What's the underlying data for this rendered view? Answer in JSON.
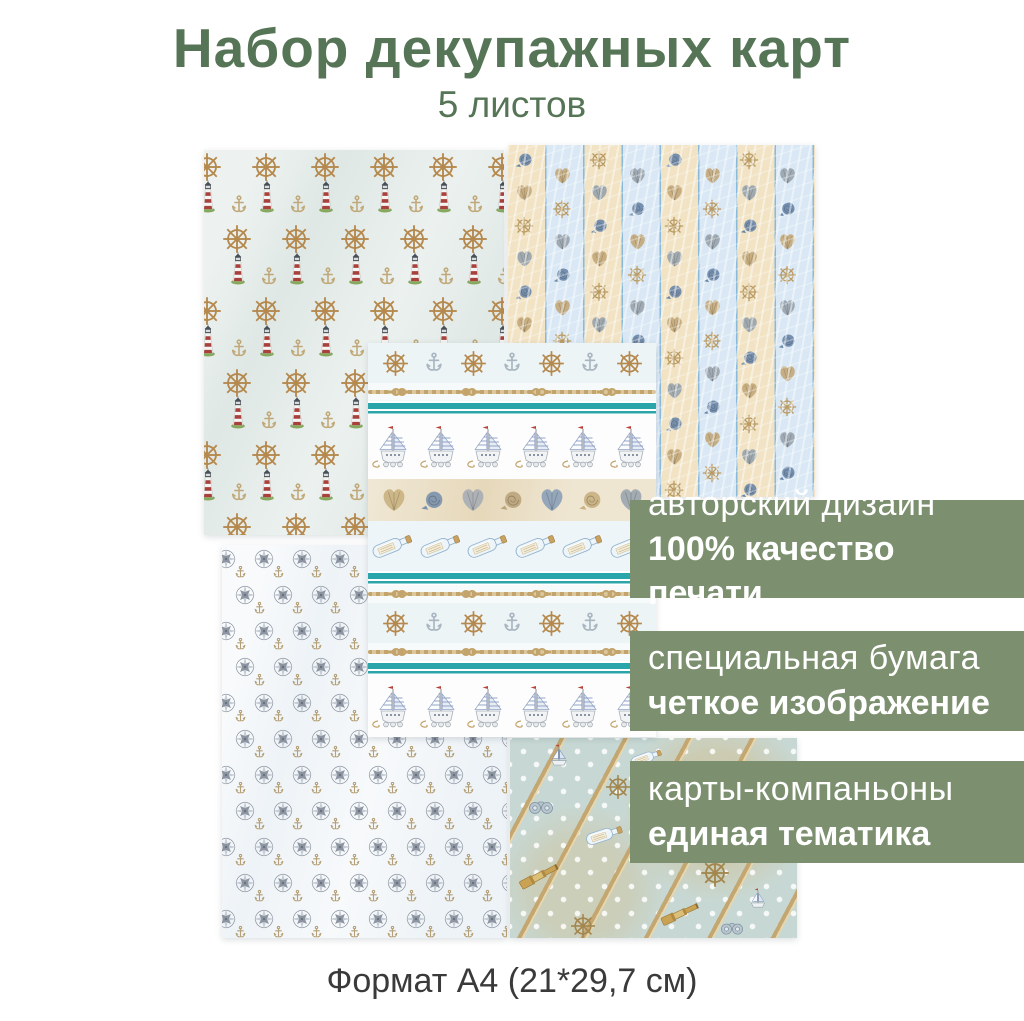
{
  "header": {
    "title": "Набор декупажных карт",
    "subtitle": "5 листов"
  },
  "banners": [
    {
      "line1": "авторский дизайн",
      "line2": "100% качество печати"
    },
    {
      "line1": "специальная бумага",
      "line2": "четкое изображение"
    },
    {
      "line1": "карты-компаньоны",
      "line2": "единая тематика"
    }
  ],
  "footer": {
    "text": "Формат А4 (21*29,7 см)"
  },
  "colors": {
    "title_green": "#567456",
    "banner_green": "#7c906f",
    "banner_text": "#ffffff",
    "footer_text": "#3a3a3a",
    "teal": "#2aa6aa",
    "rope_tan": "#c3a46c",
    "wheel_tan": "#b5894e",
    "anchor_tan": "#c0a878",
    "anchor_silver": "#a9b6c2",
    "compass_gray": "#8b94a0",
    "compass_light": "#c6ccd4",
    "stripe_cream": "#f1e3c3",
    "stripe_blue": "#d9e8f4",
    "stripe_line": "#8abadb",
    "sheet1_bg": "#dfe8e5",
    "sheet4_bg": "#eef3f7",
    "sheet5_bg": "#c7d8d4",
    "shell_band_bg": "#e6d8ba",
    "lighthouse_red": "#a8403c"
  },
  "sheets": {
    "sheet1": {
      "label": "lighthouses, ship wheels and anchors on light blue",
      "icons": [
        "ship-wheel-icon",
        "lighthouse-icon",
        "anchor-icon"
      ]
    },
    "sheet2": {
      "label": "cream and blue stripes with seashells and wheels",
      "icons": [
        "snail-shell-icon",
        "seashell-icon",
        "ship-wheel-icon"
      ]
    },
    "sheet3": {
      "label": "nautical border strips with sailboats, shells, bottles, ropes",
      "icons": [
        "ship-wheel-icon",
        "anchor-icon",
        "rope-knot-icon",
        "sailboat-icon",
        "seashell-icon",
        "message-bottle-icon"
      ],
      "bands": [
        "motifs",
        "rope",
        "teal",
        "boats",
        "shells",
        "bottles",
        "teal",
        "rope",
        "motifs",
        "rope",
        "teal",
        "boats"
      ]
    },
    "sheet4": {
      "label": "compass roses and anchors on white-blue",
      "icons": [
        "compass-rose-icon",
        "anchor-icon"
      ]
    },
    "sheet5": {
      "label": "polka dots with diagonal ropes, telescopes, bottles and boats",
      "icons": [
        "telescope-icon",
        "ship-wheel-icon",
        "message-bottle-icon",
        "sailboat-icon",
        "binoculars-icon",
        "rope-icon"
      ]
    }
  }
}
